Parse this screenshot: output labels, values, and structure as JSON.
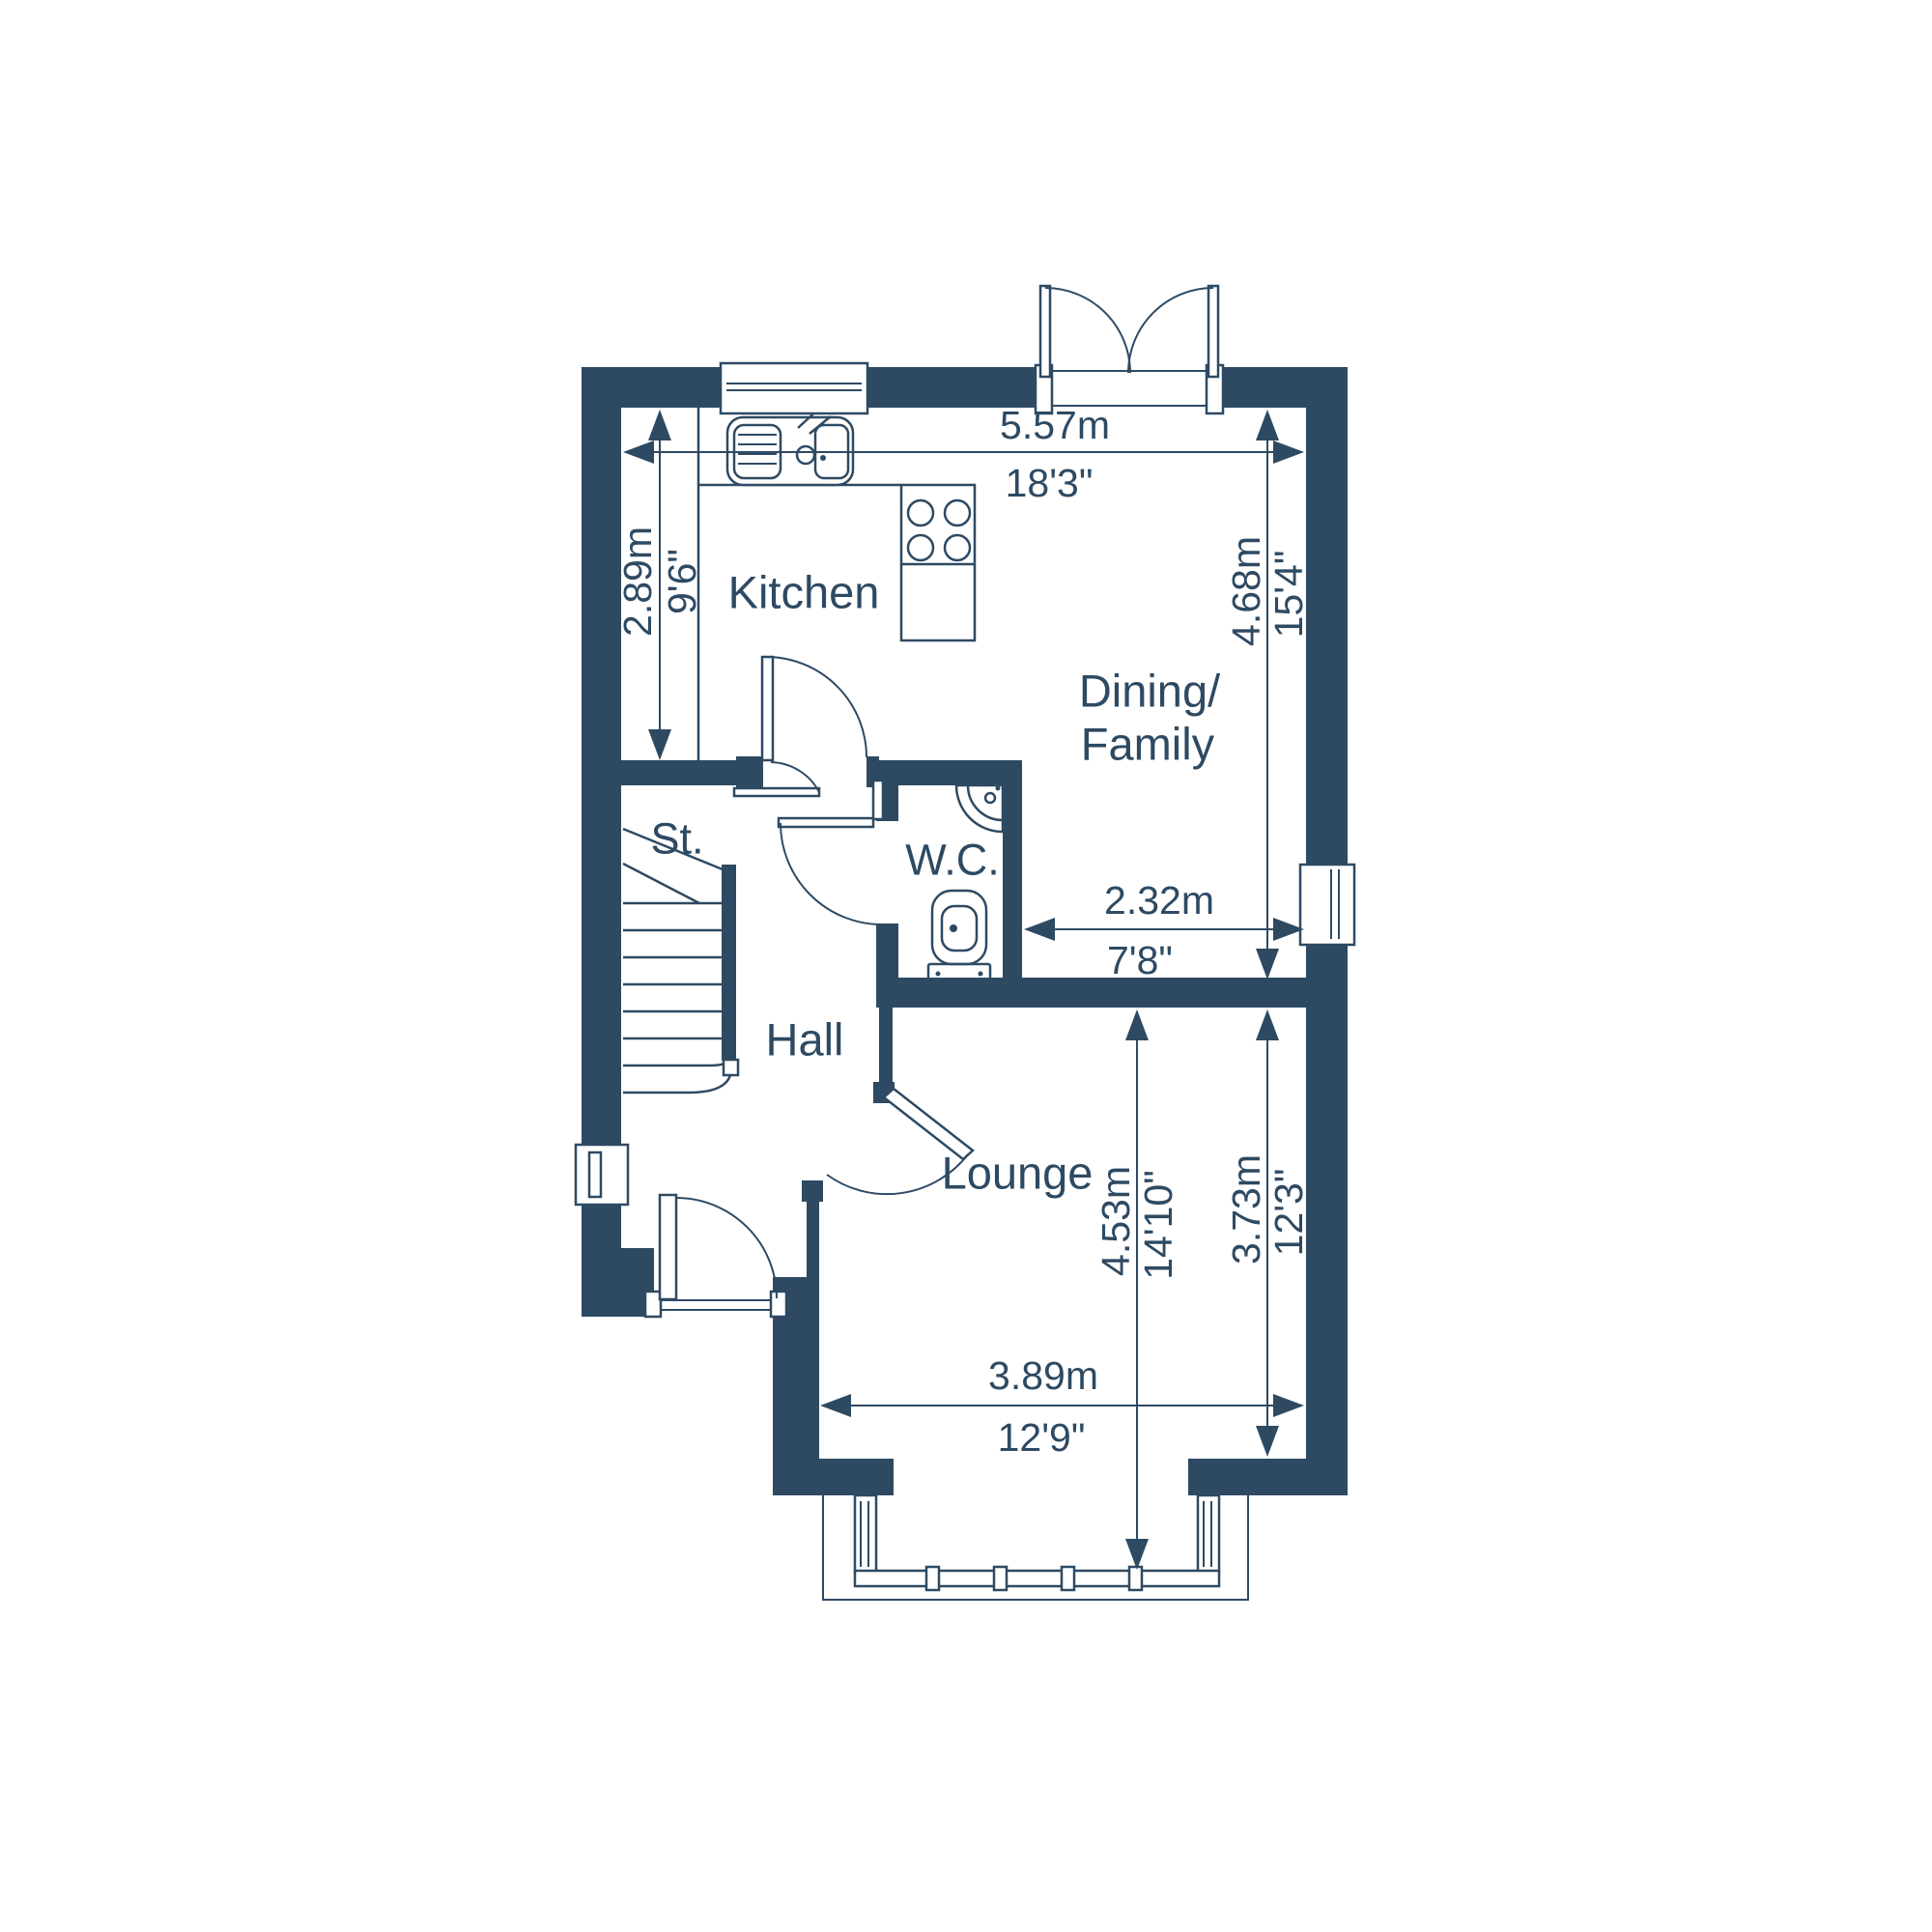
{
  "plan": {
    "type": "floorplan",
    "colors": {
      "wall": "#2e4a63",
      "background": "#ffffff"
    },
    "rooms": {
      "kitchen": "Kitchen",
      "dining_line1": "Dining/",
      "dining_line2": "Family",
      "store": "St.",
      "wc": "W.C.",
      "hall": "Hall",
      "lounge": "Lounge"
    },
    "dimensions": {
      "overall_width": {
        "metric": "5.57m",
        "imperial": "18'3\""
      },
      "kitchen_depth": {
        "metric": "2.89m",
        "imperial": "9'6\""
      },
      "dining_depth": {
        "metric": "4.68m",
        "imperial": "15'4\""
      },
      "nook_width": {
        "metric": "2.32m",
        "imperial": "7'8\""
      },
      "lounge_depth": {
        "metric": "3.73m",
        "imperial": "12'3\""
      },
      "lounge_bay_depth": {
        "metric": "4.53m",
        "imperial": "14'10\""
      },
      "lounge_width": {
        "metric": "3.89m",
        "imperial": "12'9\""
      }
    }
  }
}
